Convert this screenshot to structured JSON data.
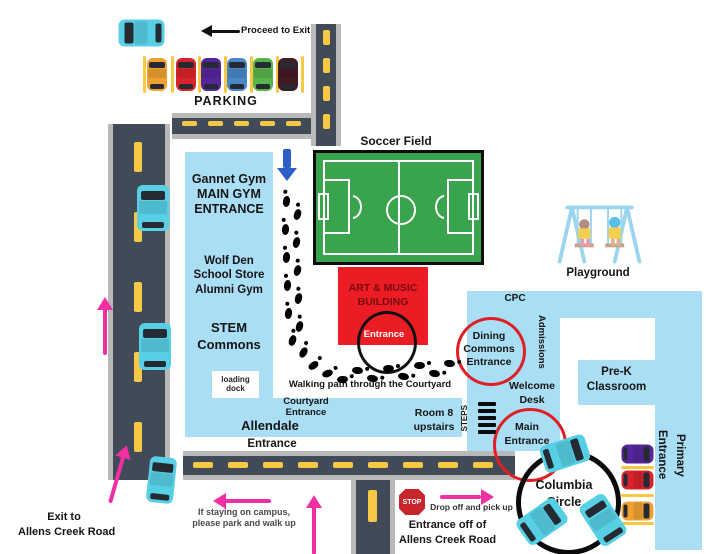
{
  "parking_area": {
    "proceed_to_exit": "Proceed to Exit",
    "parking_label": "PARKING"
  },
  "gym_building": {
    "gannet": "Gannet Gym",
    "main_gym": "MAIN GYM",
    "entrance": "ENTRANCE",
    "wolf_den": "Wolf Den",
    "school_store": "School Store",
    "alumni_gym": "Alumni Gym",
    "stem": "STEM",
    "commons": "Commons",
    "loading_dock": "loading dock"
  },
  "soccer_field": {
    "label": "Soccer Field"
  },
  "art_building": {
    "name_line1": "ART & MUSIC",
    "name_line2": "BUILDING",
    "entrance": "Entrance"
  },
  "courtyard": {
    "walking_path": "Walking path through the Courtyard",
    "entrance_line1": "Courtyard",
    "entrance_line2": "Entrance",
    "allendale": "Allendale",
    "allendale_entrance": "Entrance"
  },
  "main_building": {
    "cpc": "CPC",
    "admissions": "Admissions",
    "dining_line1": "Dining",
    "dining_line2": "Commons",
    "dining_line3": "Entrance",
    "welcome_line1": "Welcome",
    "welcome_line2": "Desk",
    "steps": "STEPS",
    "room8_line1": "Room 8",
    "room8_line2": "upstairs",
    "main_entrance_line1": "Main",
    "main_entrance_line2": "Entrance",
    "prek_line1": "Pre-K",
    "prek_line2": "Classroom",
    "primary_entrance_1": "Primary",
    "primary_entrance_2": "Entrance"
  },
  "playground": {
    "label": "Playground"
  },
  "columbia_circle": {
    "line1": "Columbia",
    "line2": "Circle"
  },
  "south": {
    "stop": "STOP",
    "drop_off": "Drop off and pick up",
    "entrance_line1": "Entrance off of",
    "entrance_line2": "Allens Creek Road",
    "exit_line1": "Exit to",
    "exit_line2": "Allens Creek Road",
    "stay_line1": "If staying on campus,",
    "stay_line2": "please park and walk up"
  },
  "colors": {
    "building": "#a9def5",
    "road": "#414b57",
    "road_edge": "#b9b9b9",
    "lane_yellow": "#f7c844",
    "field_green": "#3aa34d",
    "art_red": "#ec1c24",
    "annotation_red": "#e01f24",
    "arrow_pink": "#f02fa2",
    "arrow_blue": "#2b5fc7",
    "car_cyan": "#57d0e6"
  }
}
